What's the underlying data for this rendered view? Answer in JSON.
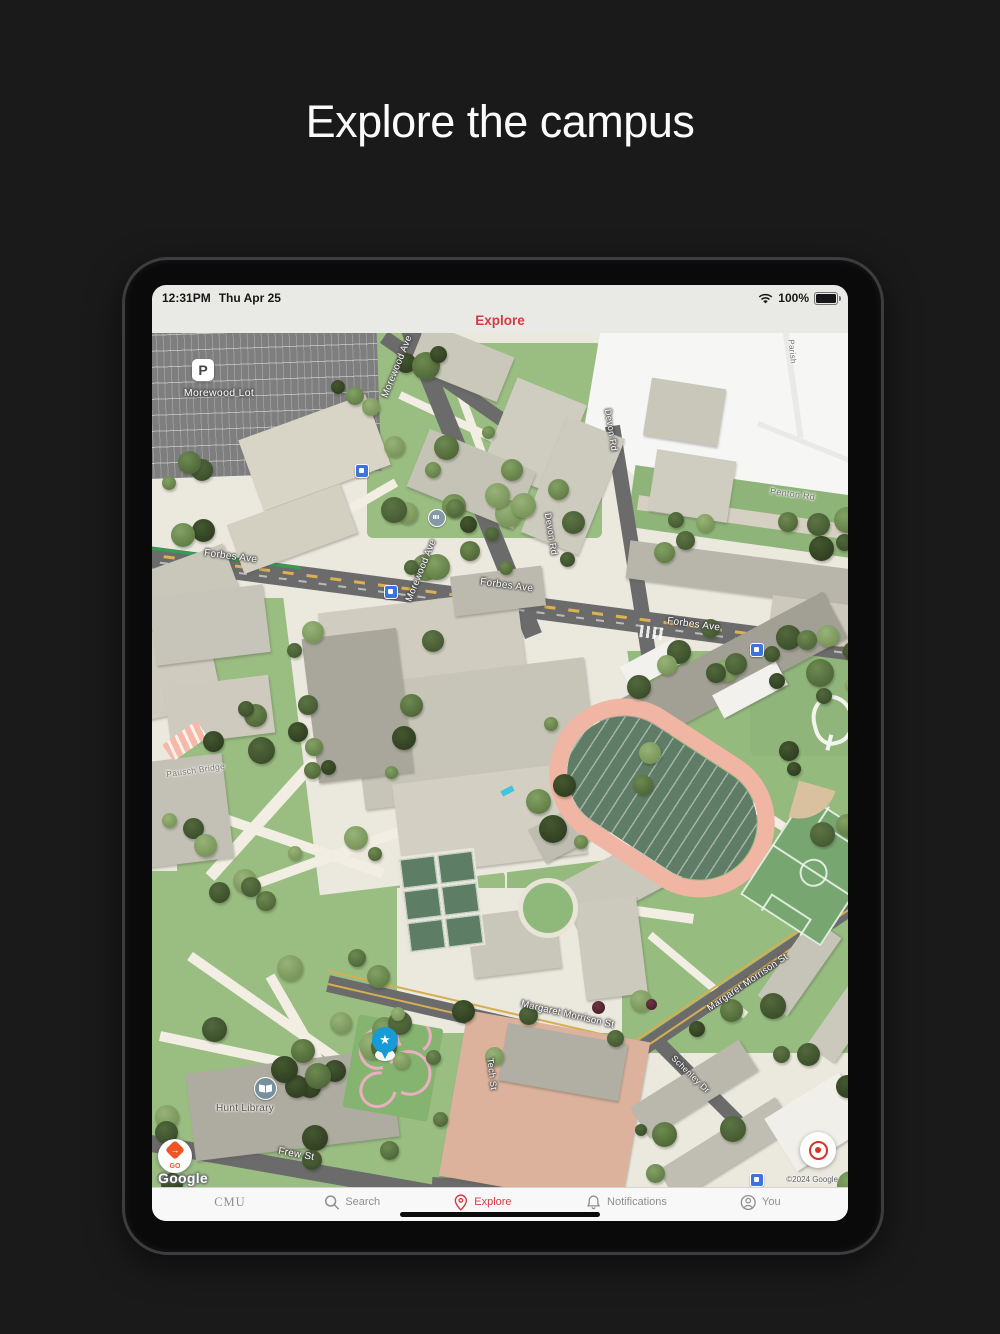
{
  "page": {
    "title": "Explore the campus"
  },
  "device": {
    "status_bar": {
      "time": "12:31PM",
      "date": "Thu Apr 25",
      "battery_percent": "100%",
      "icons": {
        "right": [
          "wifi-icon",
          "battery-icon"
        ]
      }
    },
    "nav_header": {
      "title": "Explore"
    },
    "tab_bar": {
      "active_color": "#d83a45",
      "inactive_color": "#8e8e93",
      "items": [
        {
          "id": "cmu",
          "label": "CMU",
          "icon": "cmu-wordmark",
          "active": false
        },
        {
          "id": "search",
          "label": "Search",
          "icon": "search-icon",
          "active": false
        },
        {
          "id": "explore",
          "label": "Explore",
          "icon": "map-pin-icon",
          "active": true
        },
        {
          "id": "notifications",
          "label": "Notifications",
          "icon": "bell-icon",
          "active": false
        },
        {
          "id": "you",
          "label": "You",
          "icon": "person-icon",
          "active": false
        }
      ]
    }
  },
  "map": {
    "labels": {
      "morewood_lot": "Morewood Lot",
      "forbes_ave": "Forbes Ave",
      "morewood_ave": "Morewood Ave",
      "devon_rd": "Devon Rd",
      "penton_rd": "Penton Rd",
      "parish": "Parish",
      "pausch_bridge": "Pausch Bridge",
      "margaret_morrison_st": "Margaret Morrison St",
      "tech_st": "Tech St",
      "frew_st": "Frew St",
      "schenley_dr": "Schenley Dr",
      "hunt_library": "Hunt Library"
    },
    "markers": {
      "parking_badge": "P",
      "saved_place_star": "★",
      "go_badge": "GO",
      "icons": [
        "bus-stop-icon",
        "poi-building-icon",
        "library-icon",
        "saved-pin-icon",
        "transit-shelter-icon"
      ]
    },
    "attribution": {
      "logo": "Google",
      "copyright": "©2024 Google"
    },
    "colors": {
      "green": "#9abd82",
      "road": "#6b6b6b",
      "track_pink": "#f0b5a3",
      "building": "#c9c6ba",
      "salmon_building": "#dcb29c",
      "accent_red": "#d63944"
    }
  }
}
